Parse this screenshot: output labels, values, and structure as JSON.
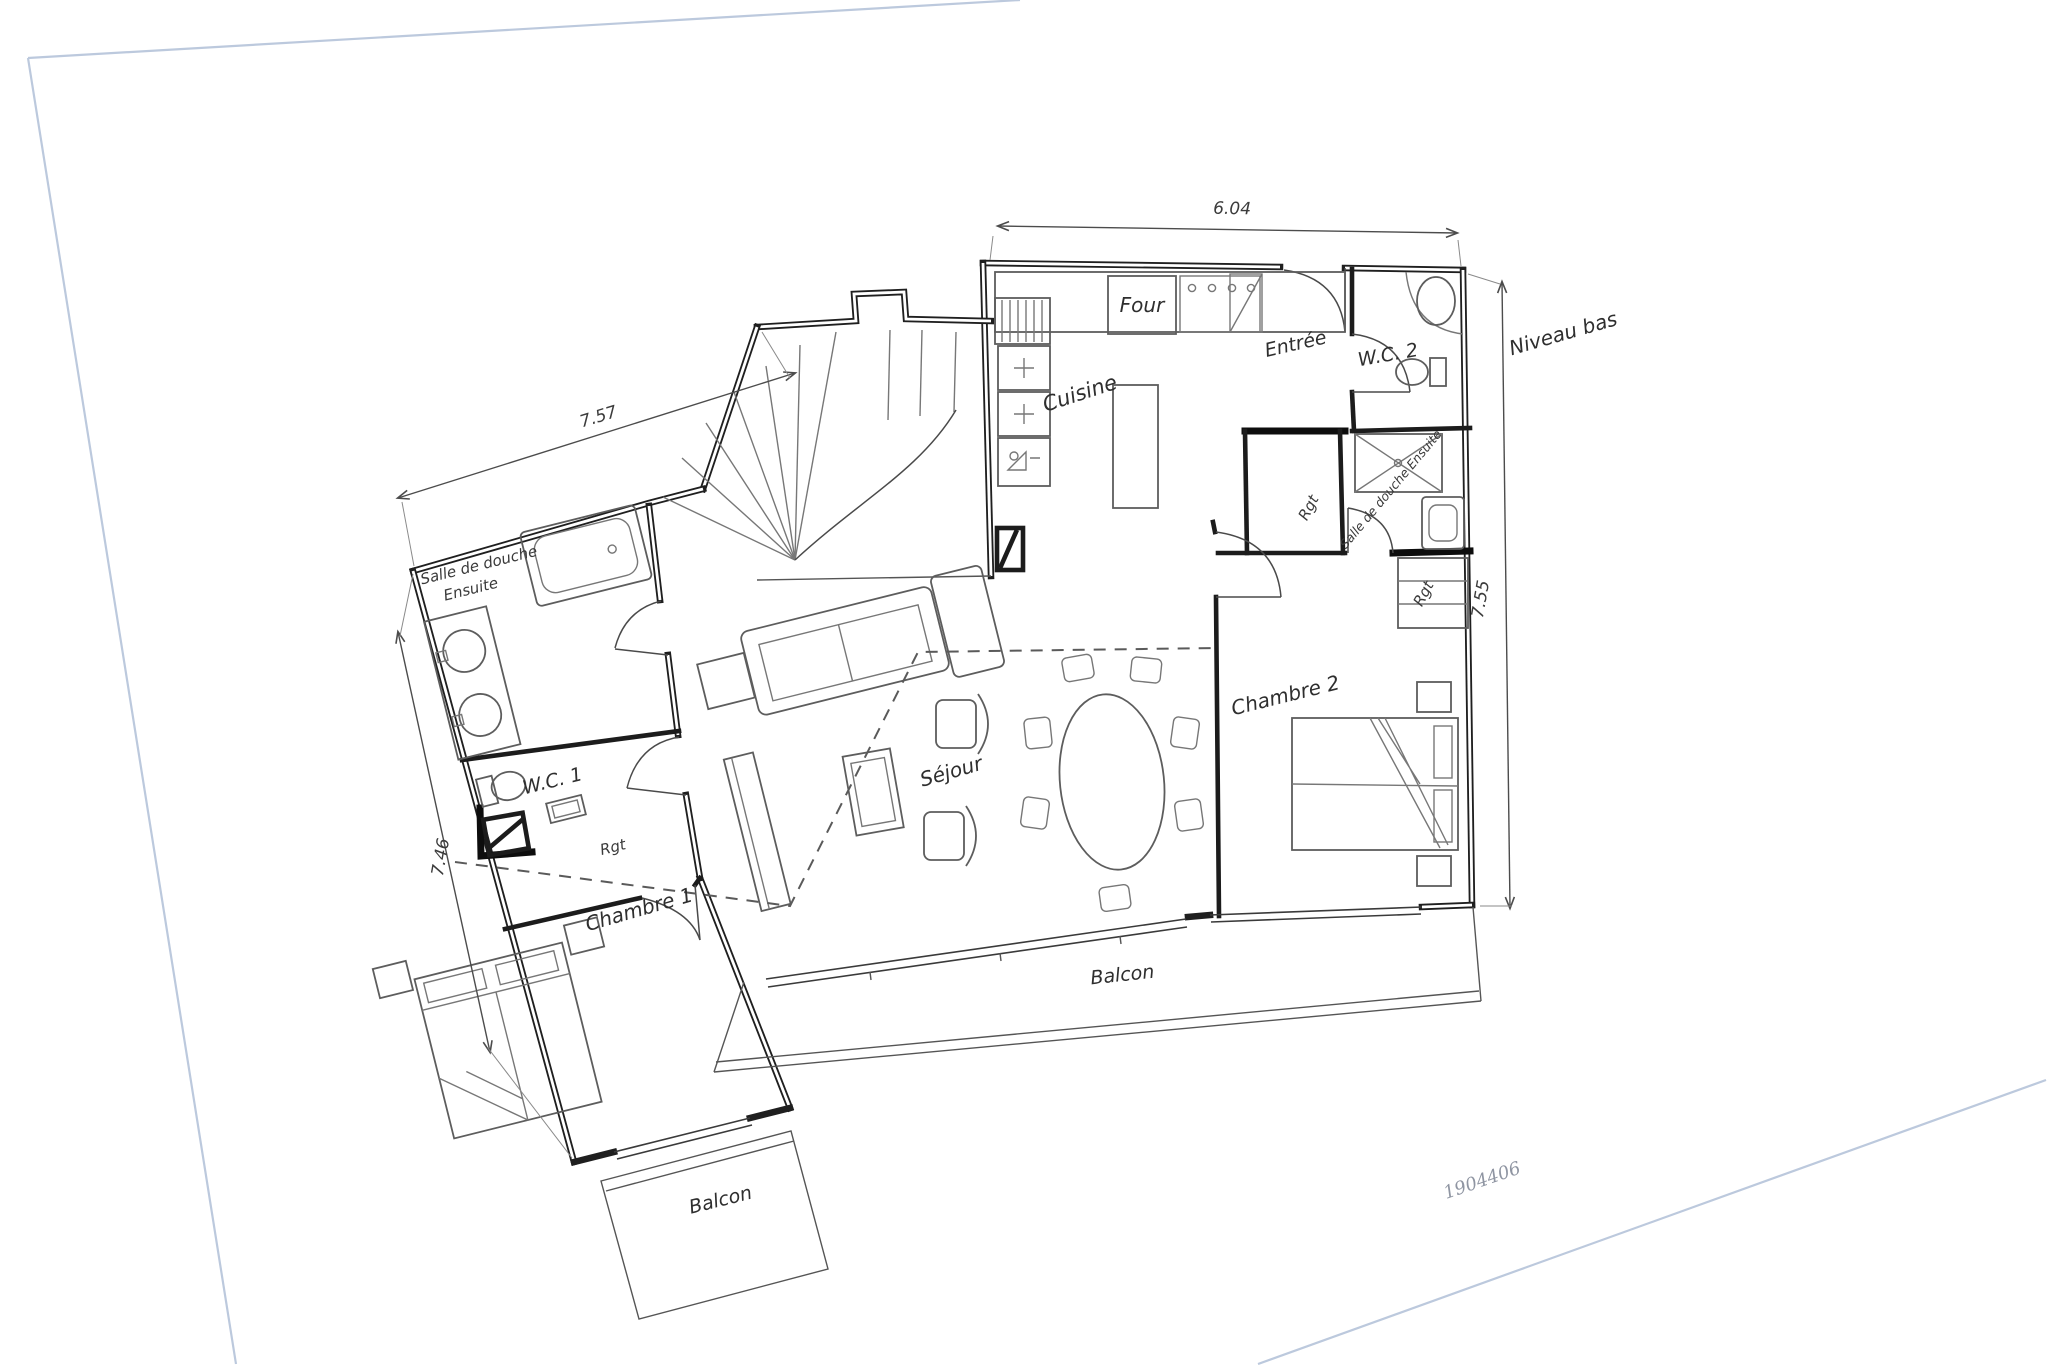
{
  "page": {
    "background": "#ffffff",
    "edge_color": "#bcc9dd",
    "reference_number": "1904406",
    "level_annotation": "Niveau bas"
  },
  "plan": {
    "ink_color": "#1f1f1f",
    "furniture_color": "#5d5d5d",
    "rooms": {
      "cuisine": "Cuisine",
      "entree": "Entrée",
      "wc2": "W.C. 2",
      "shower_ensuite_right": "Salle de douche Ensuite",
      "storage_entree": "Rgt",
      "storage_chambre2": "Rgt",
      "storage_chambre1": "Rgt",
      "chambre2": "Chambre 2",
      "sejour": "Séjour",
      "wc1": "W.C. 1",
      "chambre1": "Chambre 1",
      "shower_left_line1": "Salle de douche",
      "shower_left_line2": "Ensuite",
      "balcon_main": "Balcon",
      "balcon_chambre1": "Balcon"
    },
    "appliances": {
      "four": "Four"
    },
    "dimensions": {
      "top": "6.04",
      "left_wing_top": "7.57",
      "left_wing_side": "7.46",
      "right_side": "7.55"
    }
  }
}
